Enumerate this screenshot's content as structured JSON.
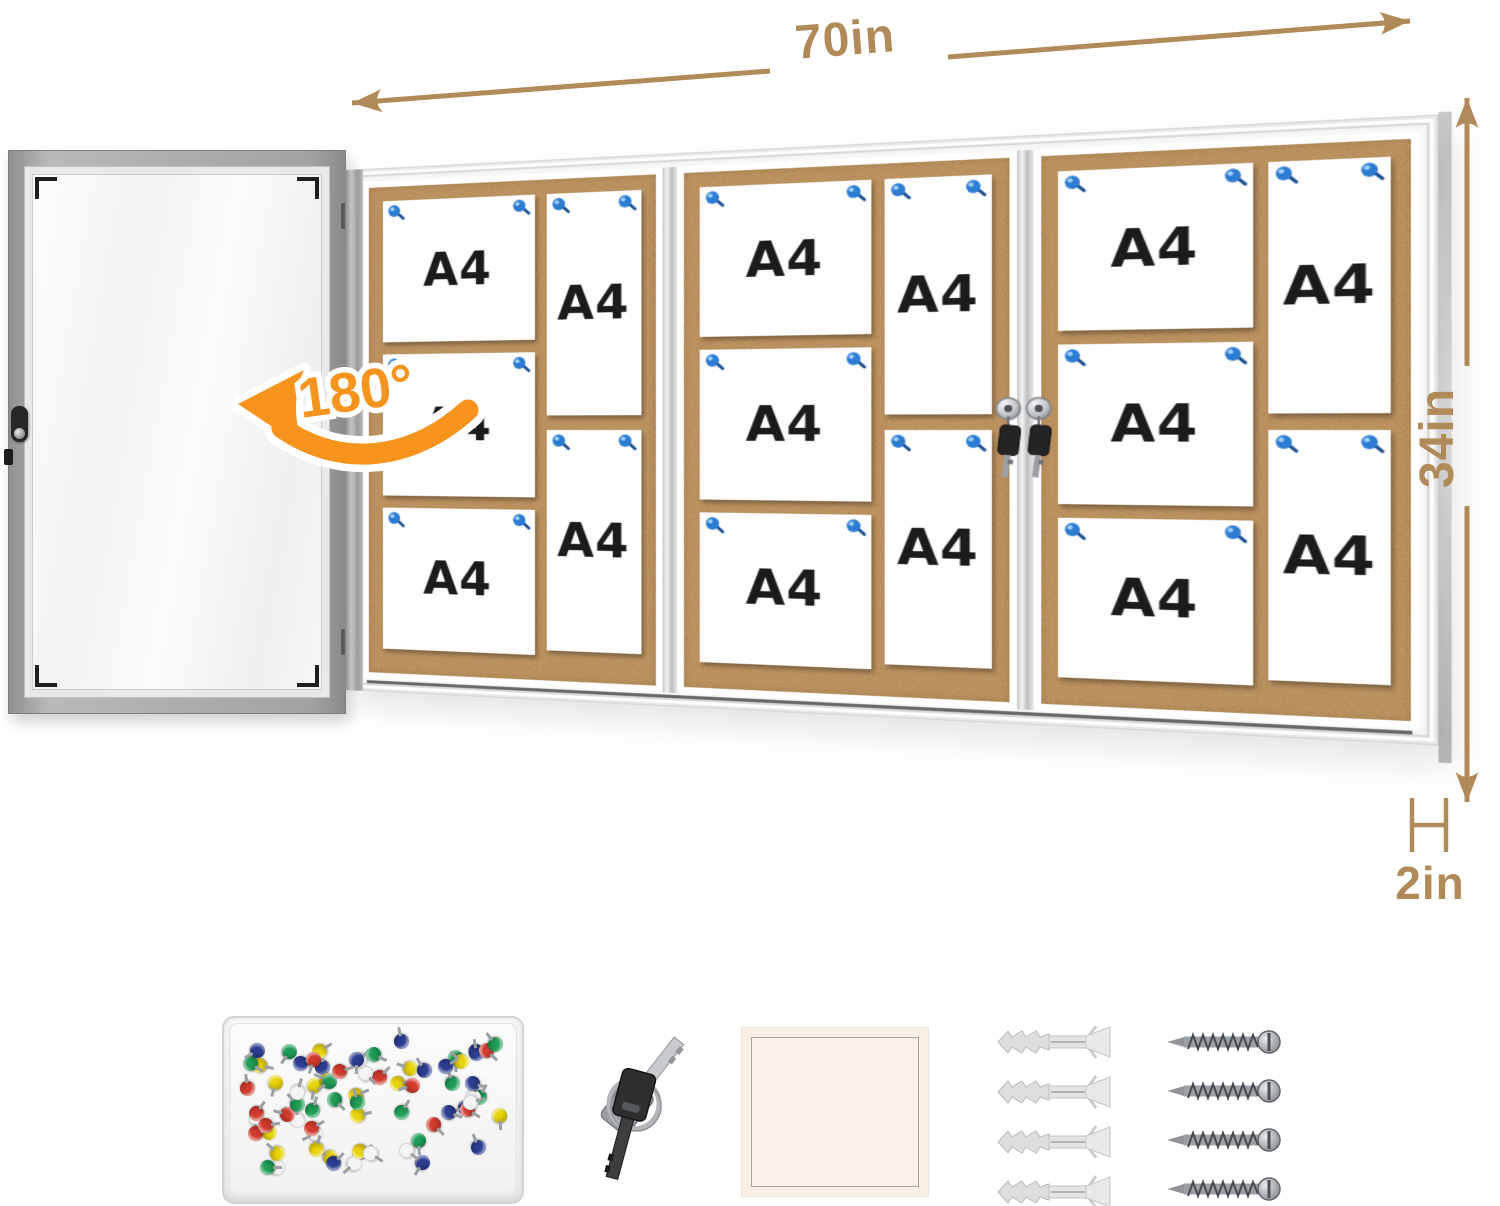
{
  "dimensions": {
    "width_label": "70in",
    "height_label": "34in",
    "depth_label": "2in",
    "swing_label": "180°",
    "dim_color": "#b18a5a",
    "swing_color": "#f7941e"
  },
  "board": {
    "cork_color": "#b5854e",
    "frame_color": "#f7f7f7",
    "pin_color": "#2d7cd3",
    "lock_count": 2,
    "panels": [
      {
        "papers": [
          "A4",
          "A4",
          "A4",
          "A4",
          "A4"
        ]
      },
      {
        "papers": [
          "A4",
          "A4",
          "A4",
          "A4",
          "A4"
        ]
      },
      {
        "papers": [
          "A4",
          "A4",
          "A4",
          "A4",
          "A4"
        ]
      }
    ]
  },
  "accessories": {
    "items": [
      "push-pin-box",
      "keys",
      "note-square",
      "wall-anchors",
      "screws"
    ],
    "push_pin_count": 72,
    "push_pin_colors": [
      "#d23b2e",
      "#e8d40a",
      "#1f9c55",
      "#2c3d91",
      "#f4f4f4"
    ],
    "key_count": 2,
    "anchor_count": 4,
    "screw_count": 4
  }
}
